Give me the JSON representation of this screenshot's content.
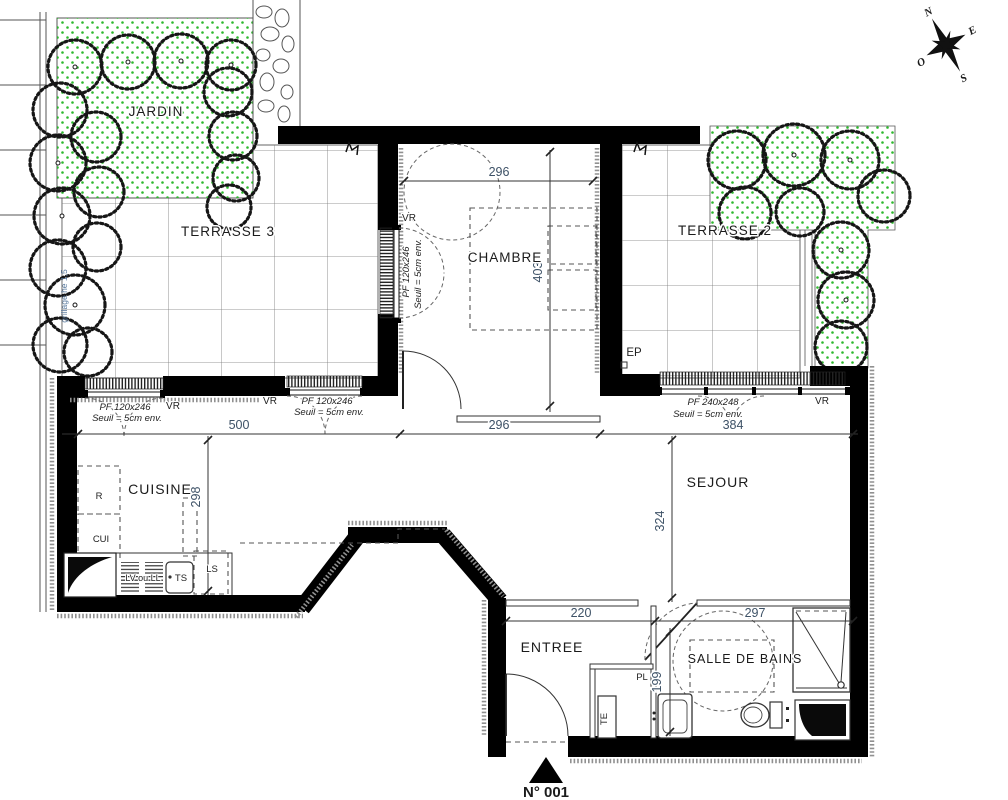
{
  "rooms": {
    "jardin": "JARDIN",
    "terrasse3": "TERRASSE 3",
    "terrasse2": "TERRASSE 2",
    "chambre": "CHAMBRE",
    "cuisine": "CUISINE",
    "sejour": "SEJOUR",
    "entree": "ENTREE",
    "salle_de_bains": "SALLE DE BAINS"
  },
  "dimensions": {
    "chambre_width": "296",
    "chambre_depth": "403",
    "kitchen_front": "500",
    "hall_front": "296",
    "sejour_front": "384",
    "cuisine_depth": "298",
    "sejour_depth": "324",
    "entree_width": "220",
    "bath_width": "297",
    "bath_depth": "199"
  },
  "windows": {
    "vr": "VR",
    "kitchen_left": {
      "label": "PF 120x246",
      "sill": "Seuil = 5cm env."
    },
    "kitchen_right": {
      "label": "PF 120x246",
      "sill": "Seuil = 5cm env."
    },
    "sejour": {
      "label": "PF 240x248",
      "sill": "Seuil = 5cm env."
    },
    "chambre": {
      "label": "PF 120x246",
      "sill": "Seuil = 5cm env."
    }
  },
  "kitchen": {
    "fridge": "R",
    "cooker": "CUI",
    "dishwasher": "LV ou LL",
    "sink": "TS",
    "ls": "LS"
  },
  "bath": {
    "closet": "PL",
    "te": "TE"
  },
  "site": {
    "rainwater": "EP",
    "fence_note": "grillage he 1,5"
  },
  "compass": {
    "north": "N",
    "south": "S",
    "east": "E",
    "west": "O"
  },
  "footer": {
    "unit_number": "N° 001"
  }
}
